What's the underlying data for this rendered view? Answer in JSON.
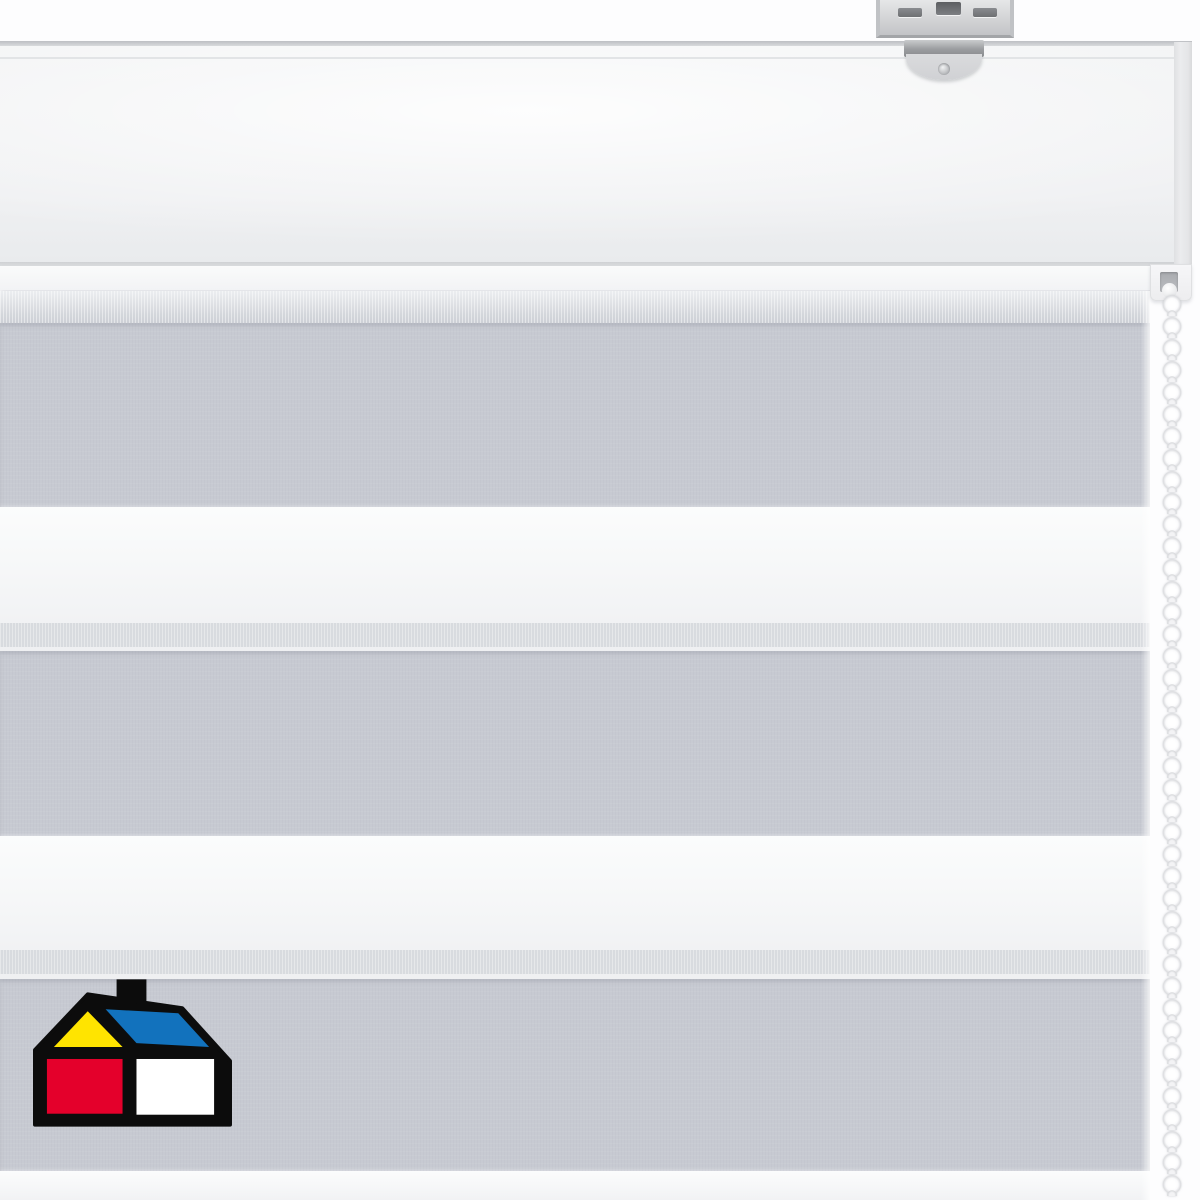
{
  "scene": {
    "description": "Product photo of a white and grey day-night zebra roller blind with white cassette headrail, galvanized metal mounting bracket, white bead pull chain on the right, and house-shaped brand logo in the lower left corner",
    "alt_labels": {
      "photo": "zebra roller blind product photo",
      "headrail": "white cassette headrail",
      "bracket": "metal mounting bracket",
      "fabric": "striped day-night blind fabric",
      "chain": "white bead pull chain",
      "logo": "house brand logo"
    }
  },
  "colors": {
    "background": "#fdfdfe",
    "gray_stripe": "#c7cad2",
    "white_stripe": "#f6f7f8",
    "edge_band": "#d8dbdf",
    "hairline": "#eff0f2",
    "headrail_face": "#f2f3f4",
    "headrail_groove": "#e2e4e6",
    "headrail_lip": "#fafbfb",
    "end_cap": "#ebecee",
    "metal_light": "#d0d1d4",
    "chain_bead": "#fbfbfc",
    "chain_shadow": "#d7d8db",
    "logo_black": "#0c0c0c",
    "logo_yellow": "#ffe400",
    "logo_blue": "#1272bd",
    "logo_red": "#e4002b",
    "logo_white": "#ffffff"
  },
  "blind": {
    "bands": [
      {
        "y": 291,
        "h": 32,
        "kind": "sheer"
      },
      {
        "y": 323,
        "h": 184,
        "kind": "gray"
      },
      {
        "y": 507,
        "h": 116,
        "kind": "white"
      },
      {
        "y": 623,
        "h": 24,
        "kind": "edge"
      },
      {
        "y": 647,
        "h": 4,
        "kind": "hairline"
      },
      {
        "y": 651,
        "h": 185,
        "kind": "gray"
      },
      {
        "y": 836,
        "h": 114,
        "kind": "white"
      },
      {
        "y": 950,
        "h": 24,
        "kind": "edge"
      },
      {
        "y": 974,
        "h": 5,
        "kind": "hairline"
      },
      {
        "y": 979,
        "h": 192,
        "kind": "gray"
      },
      {
        "y": 1171,
        "h": 29,
        "kind": "white"
      }
    ]
  },
  "chain": {
    "bead_count": 41,
    "bead_diameter": 19,
    "spacing": 22,
    "column_width": 30
  }
}
